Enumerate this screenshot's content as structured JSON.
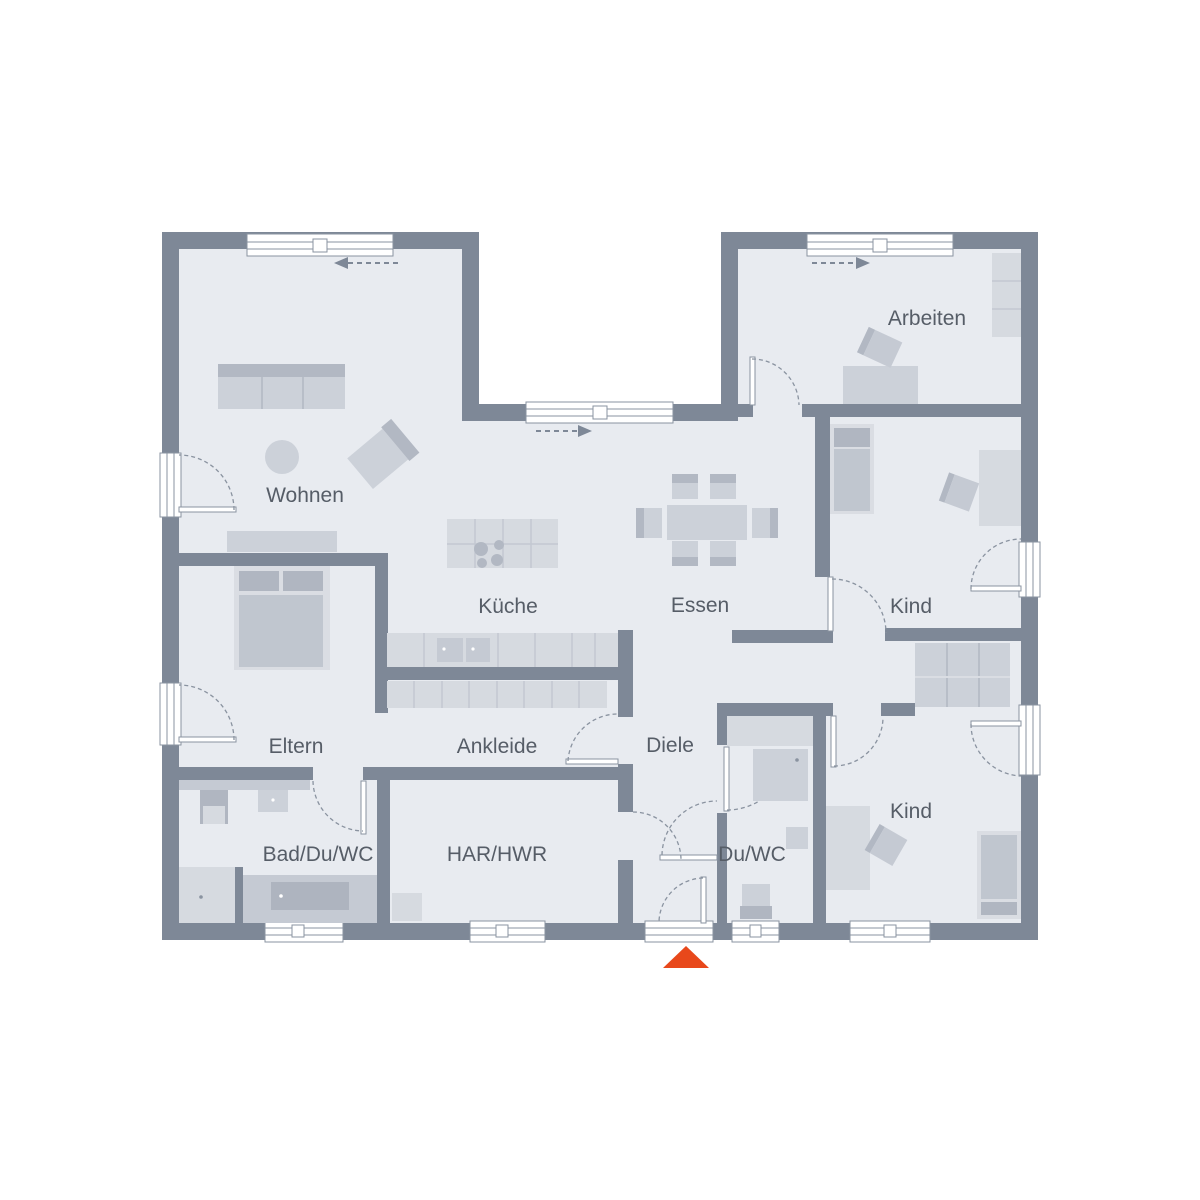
{
  "plan": {
    "rooms": {
      "wohnen": "Wohnen",
      "kueche": "Küche",
      "essen": "Essen",
      "arbeiten": "Arbeiten",
      "kind_top": "Kind",
      "kind_bottom": "Kind",
      "eltern": "Eltern",
      "ankleide": "Ankleide",
      "diele": "Diele",
      "bad": "Bad/Du/WC",
      "har": "HAR/HWR",
      "duwc": "Du/WC"
    },
    "colors": {
      "wall": "#7e8897",
      "floor": "#e8ebf0",
      "furniture_light": "#d6dae0",
      "furniture_dark": "#b2b8c3",
      "detail_line": "#8a93a0",
      "label_text": "#565d67",
      "entrance_accent": "#e8481b"
    },
    "markers": {
      "entrance_marker": "triangle-up",
      "sliding_door_arrows": 3
    }
  }
}
